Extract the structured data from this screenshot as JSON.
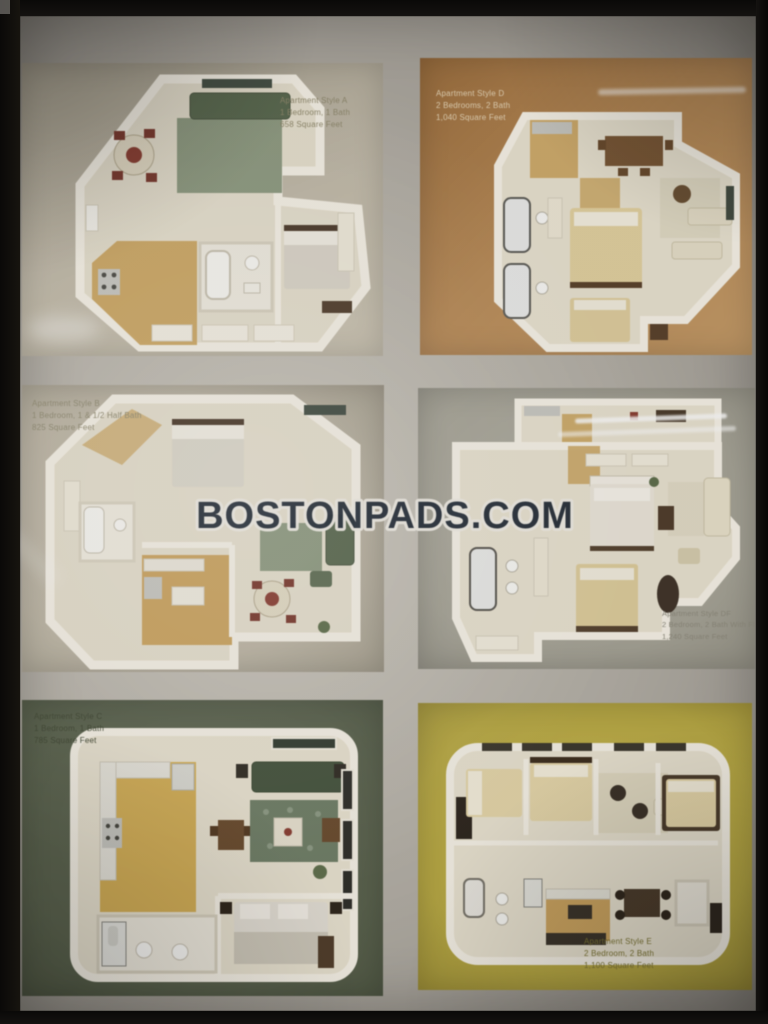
{
  "photo": {
    "watermark_text": "BOSTONPADS.COM"
  },
  "tiles": [
    {
      "id": "a",
      "label_lines": [
        "Apartment Style A",
        "1 Bedroom, 1 Bath",
        "658 Square Feet"
      ]
    },
    {
      "id": "d",
      "label_lines": [
        "Apartment Style D",
        "2 Bedrooms, 2 Bath",
        "1,040 Square Feet"
      ]
    },
    {
      "id": "b",
      "label_lines": [
        "Apartment Style B",
        "1 Bedroom, 1 & 1/2 Half Bath",
        "825 Square Feet"
      ]
    },
    {
      "id": "df",
      "label_lines": [
        "Apartment Style DF",
        "2 Bedroom, 2 Bath With Flex Space",
        "1,240 Square Feet"
      ]
    },
    {
      "id": "c",
      "label_lines": [
        "Apartment Style C",
        "1 Bedroom, 1 Bath",
        "785 Square Feet"
      ]
    },
    {
      "id": "e",
      "label_lines": [
        "Apartment Style E",
        "2 Bedroom, 2 Bath",
        "1,100 Square Feet"
      ]
    }
  ],
  "colors": {
    "tile_a_bg": "#c4bcab",
    "tile_d_bg": "#bd8a52",
    "tile_b_bg": "#c0b8a7",
    "tile_df_bg": "#a7a598",
    "tile_c_bg": "#59624d",
    "tile_e_bg": "#bcab3c",
    "frame": "#0a0908",
    "mat": "#b9b5ac",
    "watermark_fill": "#1d2836",
    "watermark_stroke": "#f2efe7"
  }
}
